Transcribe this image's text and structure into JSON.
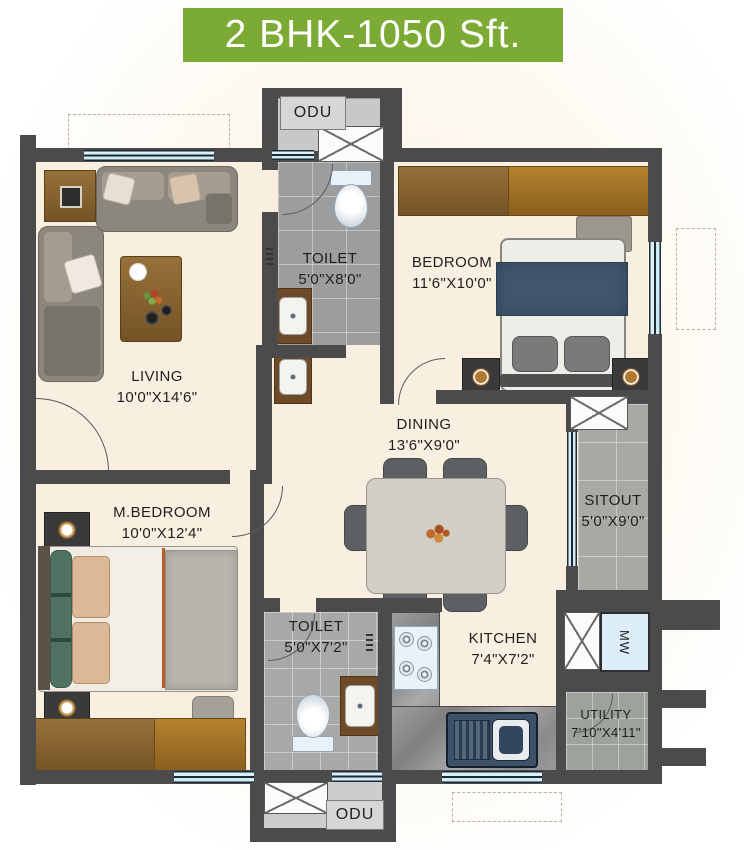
{
  "banner": {
    "title": "2 BHK-1050 Sft."
  },
  "colors": {
    "banner_green": "#7cab35",
    "wall_gray": "#4b4b4e",
    "floor_cream": "#f8efe1",
    "tile_gray": "#9d9d9d",
    "window_blue": "#cfeaf4",
    "label_text": "#1f1f1f"
  },
  "rooms": {
    "toilet_top": {
      "name": "TOILET",
      "size": "5'0\"X8'0\""
    },
    "bedroom": {
      "name": "BEDROOM",
      "size": "11'6\"X10'0\""
    },
    "living": {
      "name": "LIVING",
      "size": "10'0\"X14'6\""
    },
    "dining": {
      "name": "DINING",
      "size": "13'6\"X9'0\""
    },
    "sitout": {
      "name": "SITOUT",
      "size": "5'0\"X9'0\""
    },
    "master_bedroom": {
      "name": "M.BEDROOM",
      "size": "10'0\"X12'4\""
    },
    "toilet_bottom": {
      "name": "TOILET",
      "size": "5'0\"X7'2\""
    },
    "kitchen": {
      "name": "KITCHEN",
      "size": "7'4\"X7'2\""
    },
    "utility": {
      "name": "UTILITY",
      "size": "7'10\"X4'11\""
    }
  },
  "fixtures": {
    "odu_top": "ODU",
    "odu_bottom": "ODU",
    "microwave": "MW"
  }
}
